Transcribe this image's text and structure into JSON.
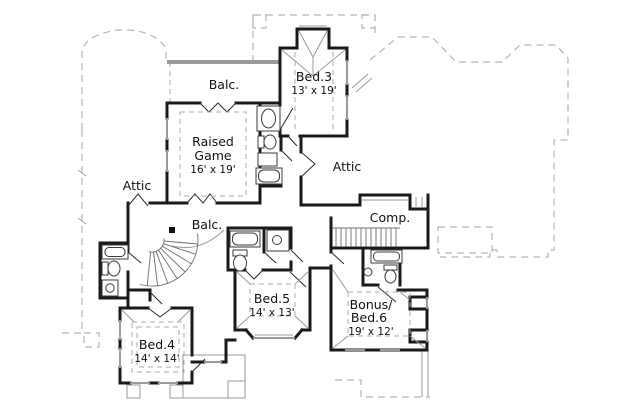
{
  "rooms": {
    "balc_top": {
      "name": "Balc."
    },
    "bed3": {
      "name": "Bed.3",
      "dims": "13' x 19'"
    },
    "raised_game": {
      "line1": "Raised",
      "line2": "Game",
      "dims": "16' x 19'"
    },
    "attic_left": {
      "name": "Attic"
    },
    "attic_right": {
      "name": "Attic"
    },
    "comp": {
      "name": "Comp."
    },
    "balc_mid": {
      "name": "Balc."
    },
    "bed5": {
      "name": "Bed.5",
      "dims": "14' x 13'"
    },
    "bonus": {
      "line1": "Bonus/",
      "line2": "Bed.6",
      "dims": "19' x 12'"
    },
    "bed4": {
      "name": "Bed.4",
      "dims": "14' x 14'"
    }
  },
  "colors": {
    "wall": "#1a1a1a",
    "detail_gray": "#9a9a9a",
    "roof_dash": "#b5b5b5",
    "text": "#111111",
    "background": "#ffffff"
  }
}
